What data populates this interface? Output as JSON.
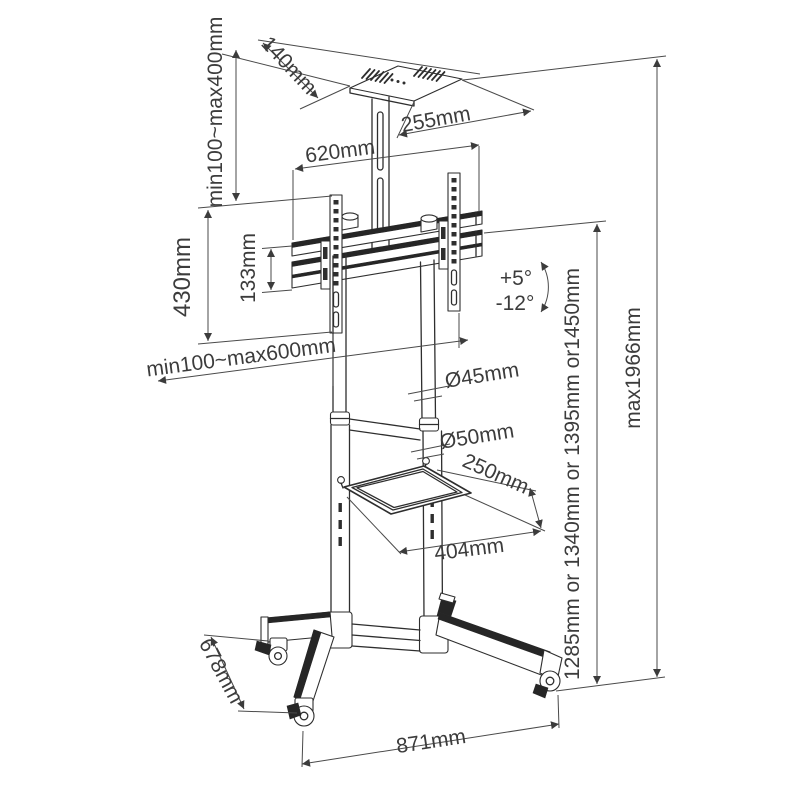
{
  "diagram": {
    "dimensions": {
      "top_shelf_depth": "140mm",
      "top_shelf_width": "255mm",
      "column_drop_range": "min100~max400mm",
      "mount_rail_length": "620mm",
      "bracket_height": "430mm",
      "rail_spacing": "133mm",
      "vesa_width_range": "min100~max600mm",
      "tilt_up": "+5°",
      "tilt_down": "-12°",
      "upper_pole_diameter": "Ø45mm",
      "lower_pole_diameter": "Ø50mm",
      "shelf_depth": "250mm",
      "shelf_width": "404mm",
      "shelf_height_options": "1285mm or 1340mm or 1395mm or1450mm",
      "max_height": "max1966mm",
      "base_depth": "678mm",
      "base_width": "871mm"
    },
    "colors": {
      "line": "#2e2e2e",
      "text": "#3c3c3c",
      "background": "#ffffff"
    }
  }
}
